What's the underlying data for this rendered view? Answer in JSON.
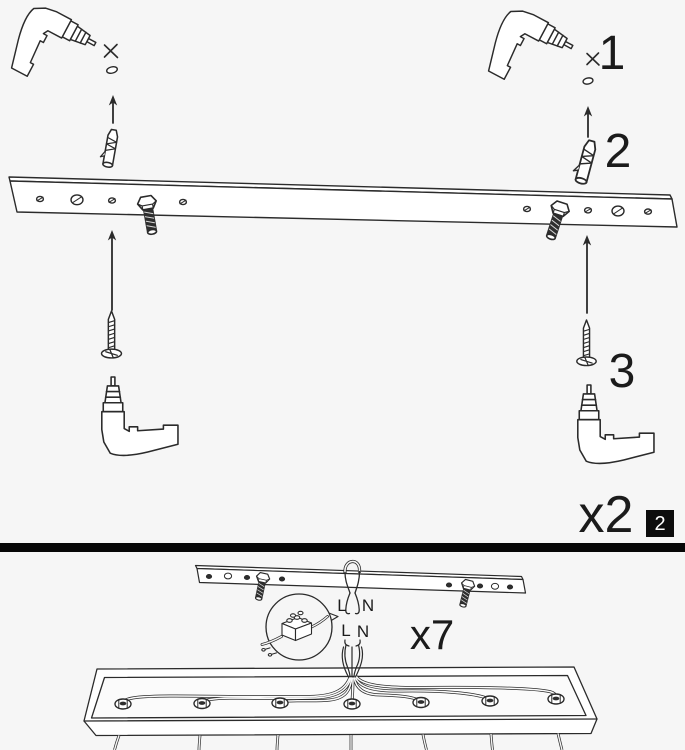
{
  "document": {
    "type": "assembly-instruction-sheet",
    "page_badge": "2"
  },
  "colors": {
    "background": "#f6f6f6",
    "line": "#2b2b2b",
    "dark_fill": "#2e2e2e",
    "divider": "#070707",
    "badge_bg": "#0d0d0d",
    "badge_text": "#ffffff"
  },
  "top_panel": {
    "step1_label": "1",
    "step2_label": "2",
    "step3_label": "3",
    "multiplier_label": "x2",
    "page_badge": "2",
    "icons": [
      "power-drill",
      "pilot-hole-cross",
      "ceiling-hole",
      "arrow-up",
      "wall-anchor",
      "mounting-rail",
      "hanger-bolt",
      "mounting-screw"
    ]
  },
  "bottom_panel": {
    "multiplier_label": "x7",
    "upper_wire": {
      "left": "L",
      "right": "N"
    },
    "lower_wire": {
      "left": "L",
      "right": "N"
    },
    "icons": [
      "mounting-rail-installed",
      "ceiling-wire",
      "terminal-block-magnifier",
      "canopy-tray",
      "cable-gland-nut",
      "pendant-wire"
    ]
  }
}
